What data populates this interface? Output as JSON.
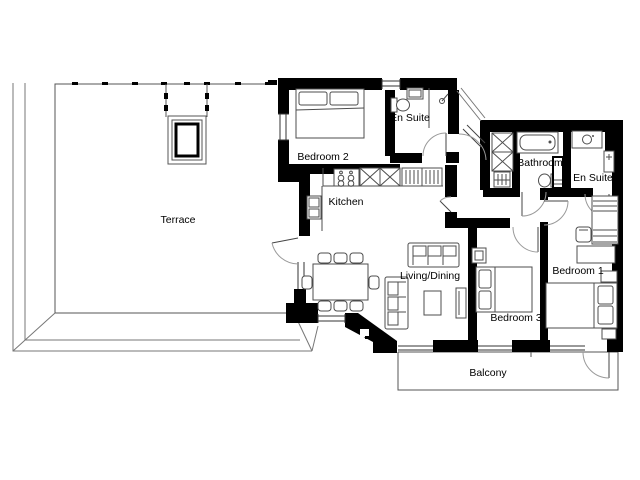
{
  "floor_plan": {
    "type": "apartment-floor-plan",
    "rooms": {
      "terrace": {
        "label": "Terrace"
      },
      "bedroom2": {
        "label": "Bedroom 2"
      },
      "en_suite_top": {
        "label": "En Suite"
      },
      "kitchen": {
        "label": "Kitchen"
      },
      "cupboard": {
        "label": "C"
      },
      "bathroom": {
        "label": "Bathroom"
      },
      "en_suite_right": {
        "label": "En Suite"
      },
      "living_dining": {
        "label": "Living/Dining"
      },
      "bedroom3": {
        "label": "Bedroom 3"
      },
      "bedroom1": {
        "label": "Bedroom 1"
      },
      "balcony": {
        "label": "Balcony"
      }
    },
    "fixtures": [
      "double-bed-icon",
      "pillow-icon",
      "wardrobe-icon",
      "desk-icon",
      "chair-icon",
      "sofa-icon",
      "coffee-table-icon",
      "tv-unit-icon",
      "dining-table-icon",
      "hob-icon",
      "kitchen-sink-icon",
      "plate-rack-icon",
      "fridge-icon",
      "bathtub-icon",
      "toilet-icon",
      "basin-icon",
      "shower-icon",
      "storage-shelf-icon",
      "door-arc-icon",
      "window-icon",
      "skylight-icon"
    ],
    "colors": {
      "wall": "#000000",
      "thin_line": "#555555",
      "furniture_line": "#4d4d4d",
      "window_line": "#333333",
      "door_arc": "#9a9a9a",
      "background": "#ffffff",
      "text": "#000000"
    }
  }
}
